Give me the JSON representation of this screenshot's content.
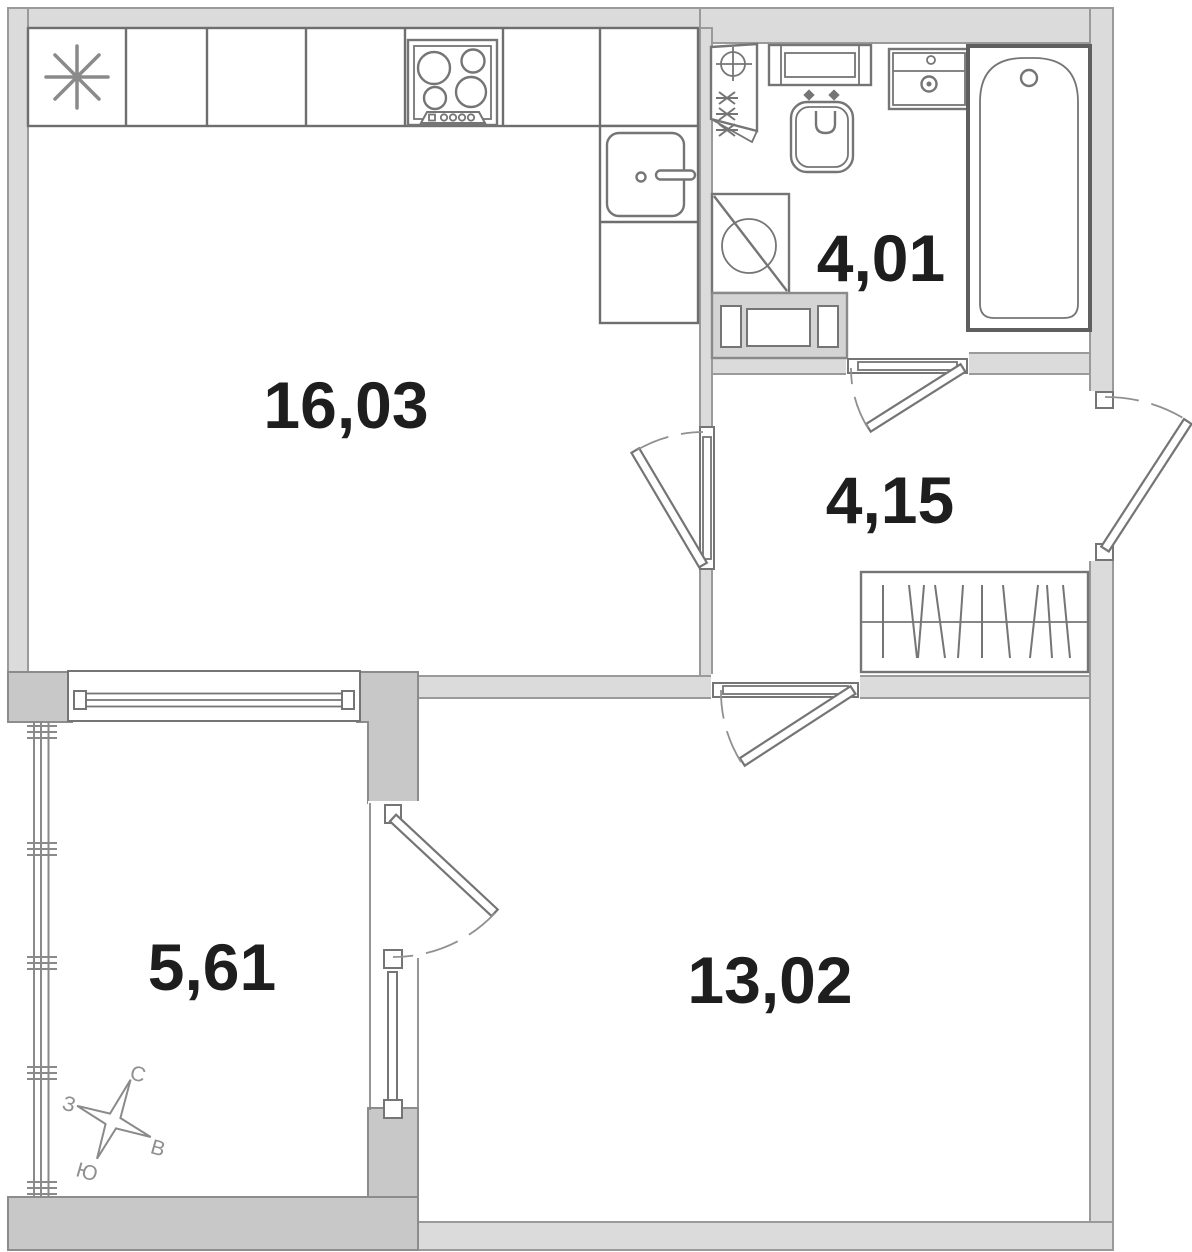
{
  "plan": {
    "type": "apartment-floor-plan",
    "rooms": [
      {
        "name": "kitchen-living-room",
        "area": "16,03"
      },
      {
        "name": "bathroom",
        "area": "4,01"
      },
      {
        "name": "hallway",
        "area": "4,15"
      },
      {
        "name": "room",
        "area": "13,02"
      },
      {
        "name": "balcony",
        "area": "5,61"
      }
    ],
    "compass": {
      "north": "С",
      "east": "В",
      "south": "Ю",
      "west": "З"
    },
    "colors": {
      "background": "#ffffff",
      "wall_light": "#dbdbdb",
      "wall_dark": "#c8c8c8",
      "fixture_line": "#757575",
      "label_text": "#1e1e1e",
      "compass": "#8f8f8f"
    }
  }
}
